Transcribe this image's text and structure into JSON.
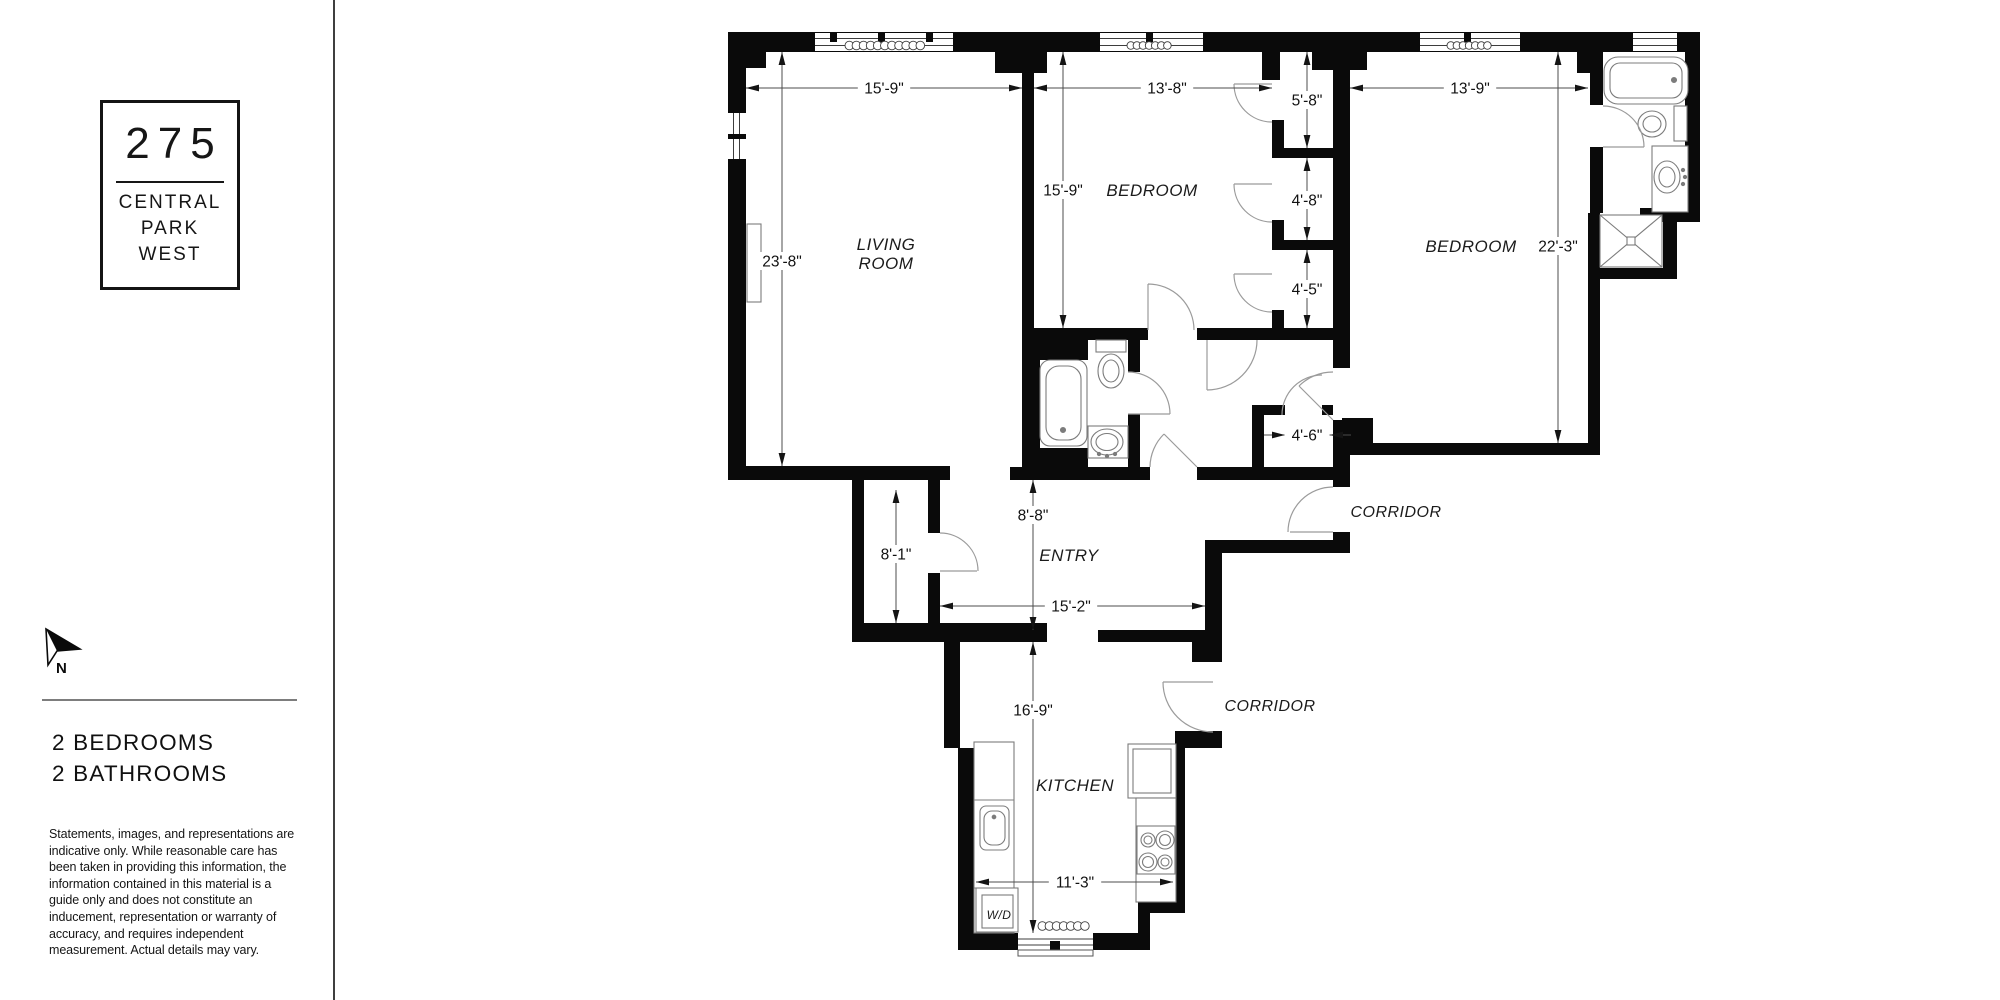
{
  "sidebar": {
    "logo": {
      "number": "275",
      "name_lines": [
        "CENTRAL",
        "PARK",
        "WEST"
      ]
    },
    "north_label": "N",
    "summary_lines": [
      "2 BEDROOMS",
      "2 BATHROOMS"
    ],
    "disclaimer_lines": [
      "Statements, images, and representations are",
      "indicative only. While reasonable care has",
      "been taken in providing this information, the",
      "information contained in this material is a",
      "guide only and does not constitute an",
      "inducement, representation or warranty of",
      "accuracy, and requires independent",
      "measurement. Actual details may vary."
    ]
  },
  "floorplan": {
    "colors": {
      "wall": "#0a0a0a",
      "dim_line": "#4c4c4c",
      "fixture_line": "#7c7c7c",
      "door_line": "#9b9b9b",
      "text": "#111111"
    },
    "rooms": [
      {
        "name": "living-room",
        "lines": [
          "LIVING",
          "ROOM"
        ],
        "x": 886,
        "y": 250,
        "size": 17
      },
      {
        "name": "bedroom-1",
        "lines": [
          "BEDROOM"
        ],
        "x": 1152,
        "y": 196,
        "size": 17
      },
      {
        "name": "bedroom-2",
        "lines": [
          "BEDROOM"
        ],
        "x": 1471,
        "y": 252,
        "size": 17
      },
      {
        "name": "entry",
        "lines": [
          "ENTRY"
        ],
        "x": 1069,
        "y": 561,
        "size": 17
      },
      {
        "name": "corridor-east",
        "lines": [
          "CORRIDOR"
        ],
        "x": 1396,
        "y": 517,
        "size": 16
      },
      {
        "name": "corridor-south",
        "lines": [
          "CORRIDOR"
        ],
        "x": 1270,
        "y": 711,
        "size": 16
      },
      {
        "name": "kitchen",
        "lines": [
          "KITCHEN"
        ],
        "x": 1075,
        "y": 791,
        "size": 17
      },
      {
        "name": "washer-dryer",
        "lines": [
          "W/D"
        ],
        "x": 999,
        "y": 919,
        "size": 12
      }
    ],
    "dimensions": [
      {
        "name": "living-room-width",
        "label": "15'-9\"",
        "orient": "h",
        "pos": 88,
        "from": 746,
        "to": 1022,
        "lc": 884
      },
      {
        "name": "bedroom1-width",
        "label": "13'-8\"",
        "orient": "h",
        "pos": 88,
        "from": 1034,
        "to": 1272,
        "lc": 1167
      },
      {
        "name": "bedroom2-width",
        "label": "13'-9\"",
        "orient": "h",
        "pos": 88,
        "from": 1350,
        "to": 1588,
        "lc": 1470
      },
      {
        "name": "closet1-depth",
        "label": "5'-8\"",
        "orient": "v",
        "pos": 1307,
        "from": 52,
        "to": 148,
        "lc": 100
      },
      {
        "name": "closet2-depth",
        "label": "4'-8\"",
        "orient": "v",
        "pos": 1307,
        "from": 158,
        "to": 240,
        "lc": 200
      },
      {
        "name": "closet3-depth",
        "label": "4'-5\"",
        "orient": "v",
        "pos": 1307,
        "from": 250,
        "to": 328,
        "lc": 289
      },
      {
        "name": "bedroom1-depth",
        "label": "15'-9\"",
        "orient": "v",
        "pos": 1063,
        "from": 52,
        "to": 328,
        "lc": 190
      },
      {
        "name": "living-room-depth",
        "label": "23'-8\"",
        "orient": "v",
        "pos": 782,
        "from": 52,
        "to": 466,
        "lc": 261
      },
      {
        "name": "bedroom2-depth",
        "label": "22'-3\"",
        "orient": "v",
        "pos": 1558,
        "from": 52,
        "to": 443,
        "lc": 246
      },
      {
        "name": "closet4-width",
        "label": "4'-6\"",
        "orient": "h",
        "pos": 435,
        "from": 1285,
        "to": 1330,
        "lc": 1307,
        "outside": true
      },
      {
        "name": "entry-depth",
        "label": "8'-8\"",
        "orient": "v",
        "pos": 1033,
        "from": 480,
        "to": 630,
        "lc": 515
      },
      {
        "name": "entry-closet-depth",
        "label": "8'-1\"",
        "orient": "v",
        "pos": 896,
        "from": 490,
        "to": 623,
        "lc": 554
      },
      {
        "name": "entry-width",
        "label": "15'-2\"",
        "orient": "h",
        "pos": 606,
        "from": 940,
        "to": 1205,
        "lc": 1071
      },
      {
        "name": "kitchen-depth",
        "label": "16'-9\"",
        "orient": "v",
        "pos": 1033,
        "from": 642,
        "to": 933,
        "lc": 710
      },
      {
        "name": "kitchen-width",
        "label": "11'-3\"",
        "orient": "h",
        "pos": 882,
        "from": 976,
        "to": 1173,
        "lc": 1075
      }
    ]
  }
}
